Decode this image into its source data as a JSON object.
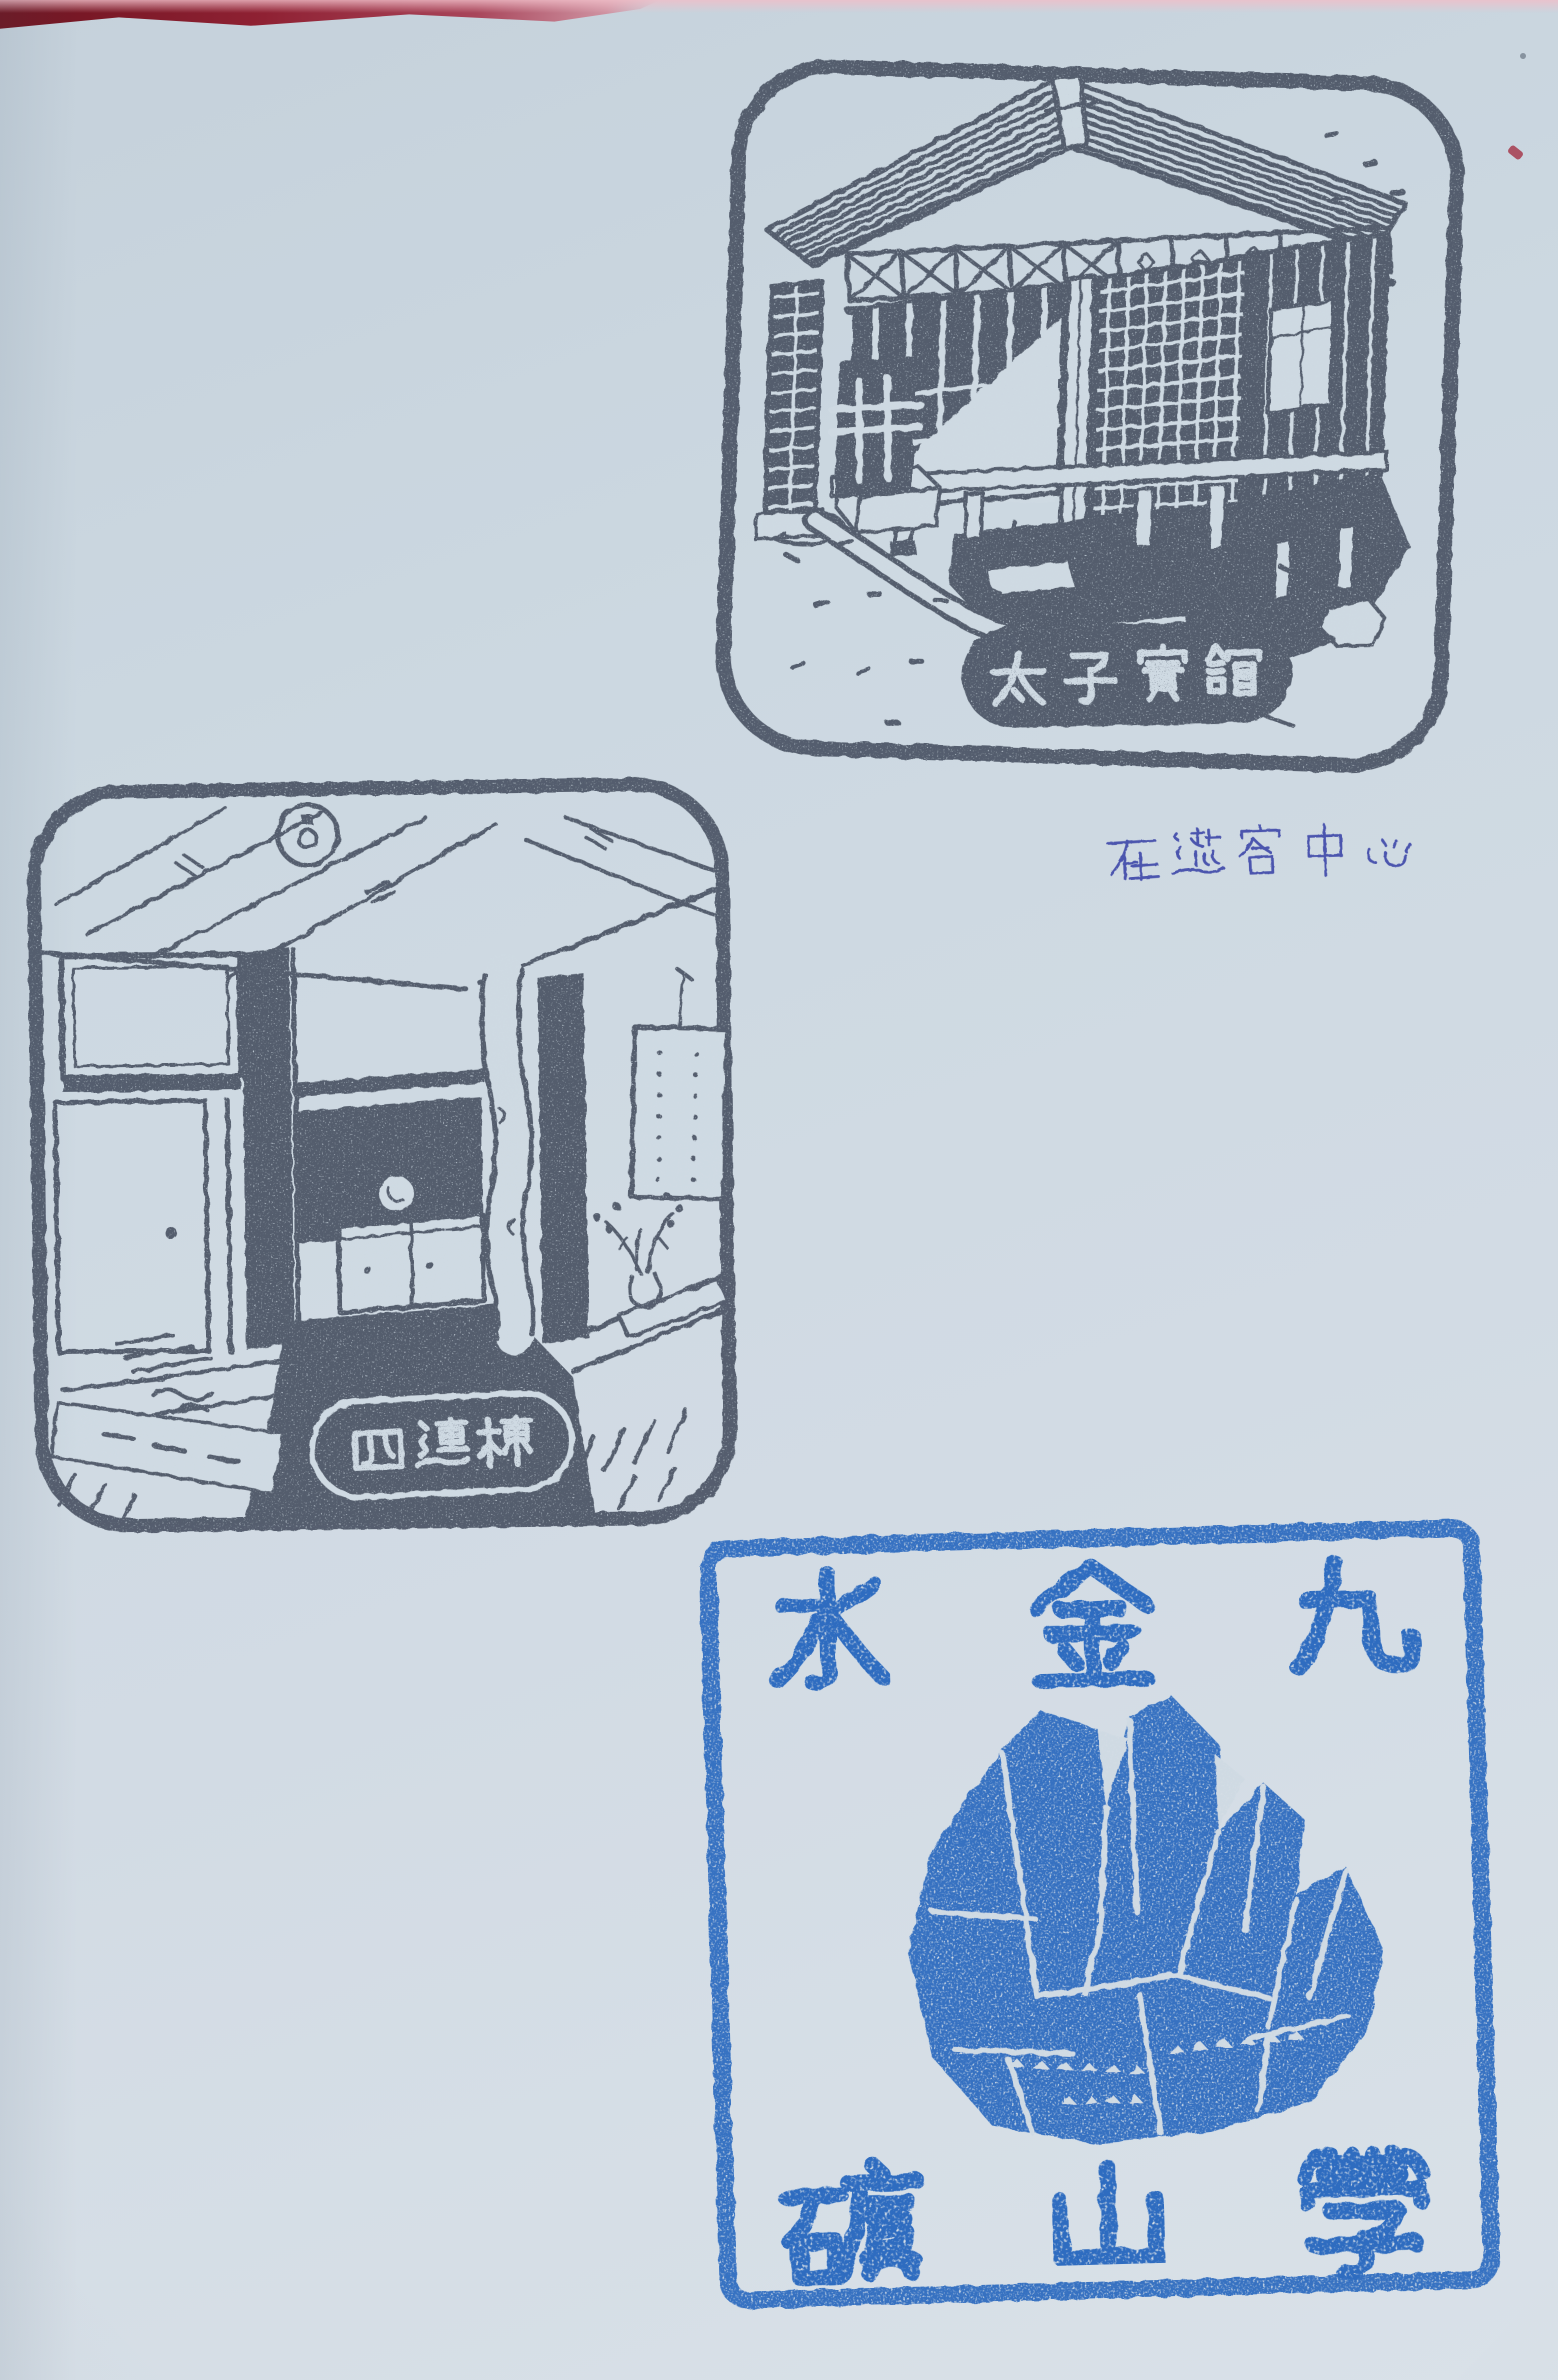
{
  "photo": {
    "description": "Stamp collection book page with three souvenir rubber stamps",
    "paper_color": "#cfdae3",
    "book_cover_color": "#8f2133"
  },
  "stamps": {
    "prince_chalet": {
      "label": "太子賓館",
      "ink_color": "#4e5766",
      "subject": "Japanese-style timber guesthouse with latticed walls, hip roof and stone path"
    },
    "four_joined": {
      "label": "四連棟",
      "ink_color": "#4e5766",
      "subject": "Japanese tatami room interior with hanging bulb, alcove cabinet, scroll and ikebana"
    },
    "mine_school": {
      "top_text": "水金九",
      "bottom_text": "礦山學",
      "ink_color": "#2e6cc0",
      "subject": "faceted quartz crystal cluster"
    }
  },
  "handwriting": {
    "text": "在遊客中心",
    "ink_color": "#4b55ae"
  }
}
